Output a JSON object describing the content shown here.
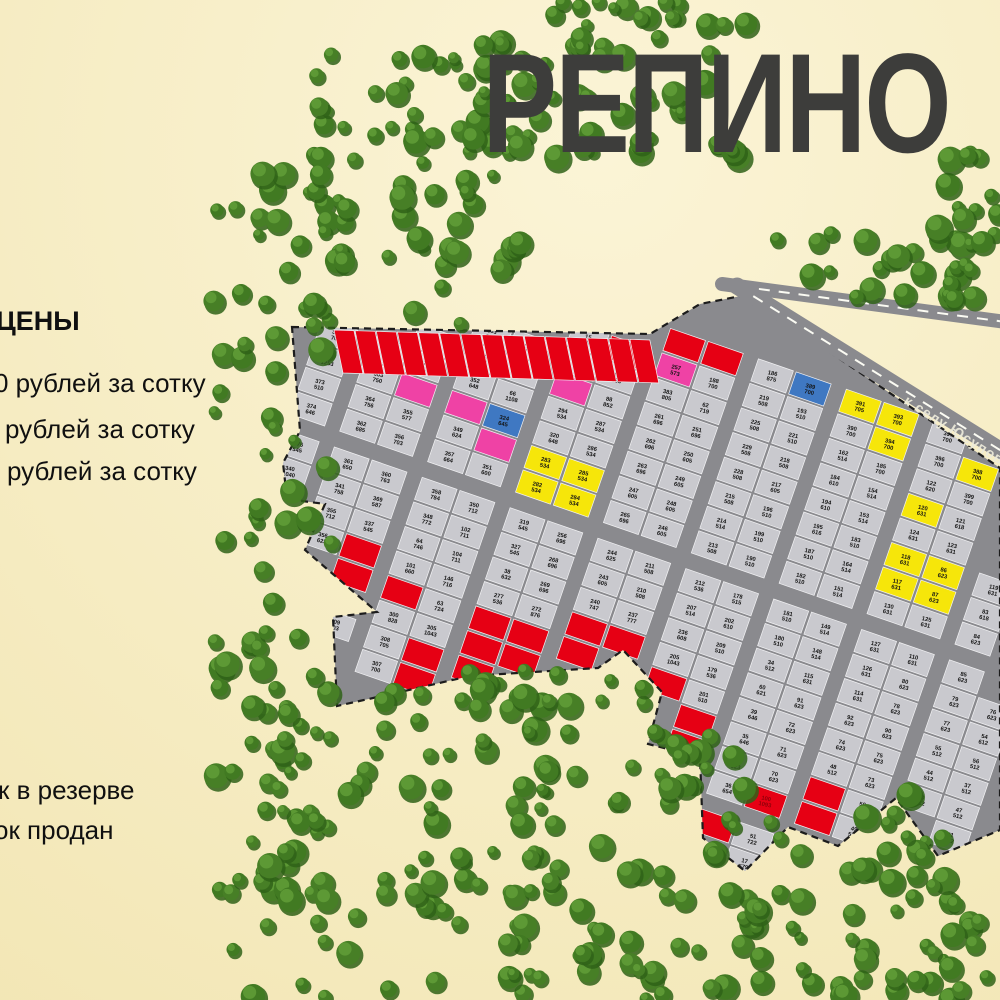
{
  "title": "РЕПИНО",
  "legend": {
    "heading": "ЦЕНЫ",
    "price_lines": [
      "0 рублей за сотку",
      "рублей за сотку",
      "рублей за сотку"
    ],
    "status_lines": [
      "к в резерве",
      "ок продан"
    ]
  },
  "road": {
    "label": "к селу Юсупово"
  },
  "palette": {
    "bg_light": "#faf3d2",
    "bg": "#f3e8ba",
    "forest_dark": "#2f6117",
    "forest": "#477f26",
    "forest_mid": "#417a22",
    "forest_light": "#63a03a",
    "road": "#8a8a8e",
    "plot": "#c9c9ce",
    "plot_line": "#f2f2f4",
    "boundary": "#1c1c1c",
    "red": "#e60014",
    "red_text": "#8f000a",
    "yellow": "#f6e60a",
    "pink": "#ef42a5",
    "blue": "#3f78c2",
    "title_color": "#3d3d3b",
    "text": "#141414",
    "road_dash": "#fbfbf3"
  },
  "map": {
    "estate_polygon": [
      [
        292,
        327
      ],
      [
        650,
        334
      ],
      [
        700,
        304
      ],
      [
        746,
        295
      ],
      [
        1000,
        468
      ],
      [
        1000,
        830
      ],
      [
        938,
        856
      ],
      [
        896,
        798
      ],
      [
        838,
        846
      ],
      [
        788,
        827
      ],
      [
        745,
        871
      ],
      [
        703,
        838
      ],
      [
        700,
        757
      ],
      [
        648,
        744
      ],
      [
        662,
        692
      ],
      [
        623,
        650
      ],
      [
        598,
        668
      ],
      [
        470,
        676
      ],
      [
        400,
        692
      ],
      [
        337,
        706
      ],
      [
        333,
        617
      ],
      [
        377,
        612
      ],
      [
        305,
        550
      ],
      [
        325,
        504
      ],
      [
        287,
        499
      ],
      [
        283,
        463
      ],
      [
        300,
        431
      ]
    ],
    "lattice": {
      "origin": [
        318,
        205
      ],
      "r": [
        0.945,
        0.327
      ],
      "c": [
        -0.327,
        0.945
      ],
      "depth": 40,
      "front": 26,
      "road_w": 13,
      "cross_w": 14,
      "rows": 19,
      "cols": 24,
      "pair": 2,
      "cross_every": 8
    },
    "red_row": {
      "x1": 334,
      "y1": 330,
      "x2": 651,
      "y2": 340,
      "count": 15,
      "lean": 9,
      "height": 43
    },
    "roads": [
      {
        "x1": 722,
        "y1": 284,
        "x2": 1006,
        "y2": 322,
        "w": 14
      },
      {
        "x1": 737,
        "y1": 286,
        "x2": 1008,
        "y2": 455,
        "w": 17
      }
    ],
    "areas_pool": [
      508,
      510,
      514,
      534,
      536,
      545,
      605,
      610,
      614,
      623,
      625,
      631,
      646,
      696,
      700,
      703,
      712,
      722
    ],
    "plots": [
      [
        724,
        308,
        "",
        "",
        "red"
      ],
      [
        676,
        332,
        "",
        "",
        "red"
      ],
      [
        652,
        348,
        "",
        "",
        "red"
      ],
      [
        333,
        568,
        "",
        "",
        "red"
      ],
      [
        351,
        581,
        "",
        "",
        "red"
      ],
      [
        368,
        594,
        "",
        "",
        "red"
      ],
      [
        405,
        650,
        "",
        "",
        "red"
      ],
      [
        425,
        658,
        "",
        "",
        "red"
      ],
      [
        447,
        664,
        "",
        "",
        "red"
      ],
      [
        467,
        670,
        "",
        "",
        "red"
      ],
      [
        482,
        652,
        "",
        "",
        "red"
      ],
      [
        502,
        656,
        "",
        "",
        "red"
      ],
      [
        522,
        660,
        "",
        "",
        "red"
      ],
      [
        541,
        664,
        "",
        "",
        "red"
      ],
      [
        560,
        667,
        "",
        "",
        "red"
      ],
      [
        611,
        658,
        "",
        "",
        "red"
      ],
      [
        650,
        698,
        "",
        "",
        "red"
      ],
      [
        667,
        718,
        "",
        "",
        "red"
      ],
      [
        683,
        740,
        "",
        "",
        "red"
      ],
      [
        721,
        812,
        "",
        "",
        "red"
      ],
      [
        760,
        813,
        "100",
        "1093",
        "red"
      ],
      [
        789,
        810,
        "",
        "",
        "red"
      ],
      [
        816,
        810,
        "",
        "",
        "red"
      ],
      [
        552,
        459,
        "283",
        "534",
        "yellow"
      ],
      [
        572,
        473,
        "285",
        "534",
        "yellow"
      ],
      [
        559,
        489,
        "284",
        "534",
        "yellow"
      ],
      [
        548,
        506,
        "282",
        "534",
        "yellow"
      ],
      [
        914,
        517,
        "120",
        "631",
        "yellow"
      ],
      [
        895,
        553,
        "118",
        "631",
        "yellow"
      ],
      [
        882,
        567,
        "117",
        "631",
        "yellow"
      ],
      [
        932,
        567,
        "86",
        "623",
        "yellow"
      ],
      [
        922,
        581,
        "87",
        "623",
        "yellow"
      ],
      [
        853,
        393,
        "391",
        "705",
        "yellow"
      ],
      [
        886,
        419,
        "393",
        "700",
        "yellow"
      ],
      [
        905,
        432,
        "394",
        "700",
        "yellow"
      ],
      [
        965,
        471,
        "388",
        "700",
        "yellow"
      ],
      [
        504,
        424,
        "324",
        "645",
        "blue"
      ],
      [
        799,
        367,
        "389",
        "700",
        "blue"
      ],
      [
        432,
        403,
        "",
        "",
        "pink"
      ],
      [
        457,
        401,
        "",
        "",
        "pink"
      ],
      [
        491,
        442,
        "",
        "",
        "pink"
      ],
      [
        551,
        369,
        "",
        "",
        "pink"
      ],
      [
        696,
        372,
        "257",
        "573",
        "pink"
      ],
      [
        322,
        350,
        "365",
        "1253"
      ],
      [
        345,
        396,
        "364",
        "756"
      ],
      [
        369,
        398,
        "363",
        "750"
      ],
      [
        352,
        421,
        "362",
        "685"
      ],
      [
        358,
        448,
        "361",
        "650"
      ],
      [
        364,
        468,
        "360",
        "763"
      ],
      [
        296,
        477,
        "340",
        "1040"
      ],
      [
        330,
        492,
        "341",
        "758"
      ],
      [
        362,
        492,
        "369",
        "587"
      ],
      [
        406,
        404,
        "355",
        "577"
      ],
      [
        400,
        432,
        "356",
        "703"
      ],
      [
        398,
        458,
        "357",
        "664"
      ],
      [
        400,
        488,
        "358",
        "784"
      ],
      [
        433,
        459,
        "349",
        "624"
      ],
      [
        432,
        488,
        "348",
        "772"
      ],
      [
        353,
        602,
        "309",
        "703"
      ],
      [
        347,
        625,
        "308",
        "705"
      ],
      [
        340,
        644,
        "307",
        "700"
      ],
      [
        335,
        663,
        "300",
        "828"
      ],
      [
        379,
        659,
        "305",
        "1043"
      ],
      [
        478,
        408,
        "352",
        "648"
      ],
      [
        478,
        428,
        "351",
        "600"
      ],
      [
        470,
        450,
        "350",
        "712"
      ],
      [
        524,
        442,
        "320",
        "648"
      ],
      [
        516,
        472,
        "319",
        "545"
      ],
      [
        510,
        492,
        "327",
        "545"
      ],
      [
        596,
        436,
        "287",
        "534"
      ],
      [
        585,
        452,
        "286",
        "534"
      ],
      [
        539,
        475,
        "294",
        "534"
      ],
      [
        602,
        498,
        "265",
        "696"
      ],
      [
        622,
        466,
        "263",
        "696"
      ],
      [
        637,
        449,
        "262",
        "696"
      ],
      [
        590,
        515,
        "256",
        "696"
      ],
      [
        570,
        546,
        "268",
        "696"
      ],
      [
        558,
        561,
        "269",
        "696"
      ],
      [
        607,
        550,
        "244",
        "625"
      ],
      [
        600,
        566,
        "243",
        "605"
      ],
      [
        482,
        607,
        "277",
        "536"
      ],
      [
        521,
        614,
        "272",
        "876"
      ],
      [
        555,
        612,
        "240",
        "747"
      ],
      [
        596,
        659,
        "237",
        "777"
      ],
      [
        637,
        673,
        "205",
        "1043"
      ],
      [
        648,
        433,
        "261",
        "696"
      ],
      [
        682,
        431,
        "251",
        "696"
      ],
      [
        671,
        437,
        "250",
        "605"
      ],
      [
        671,
        467,
        "249",
        "605"
      ],
      [
        663,
        482,
        "248",
        "605"
      ],
      [
        653,
        498,
        "247",
        "605"
      ],
      [
        648,
        514,
        "246",
        "605"
      ],
      [
        731,
        429,
        "225",
        "508"
      ],
      [
        718,
        445,
        "229",
        "508"
      ],
      [
        708,
        465,
        "228",
        "508"
      ],
      [
        720,
        493,
        "215",
        "508"
      ],
      [
        707,
        510,
        "214",
        "514"
      ],
      [
        698,
        528,
        "213",
        "508"
      ],
      [
        688,
        545,
        "212",
        "536"
      ],
      [
        678,
        562,
        "211",
        "508"
      ],
      [
        668,
        580,
        "210",
        "508"
      ],
      [
        603,
        610,
        "236",
        "608"
      ],
      [
        635,
        622,
        "207",
        "514"
      ],
      [
        660,
        624,
        "209",
        "510"
      ],
      [
        678,
        613,
        "202",
        "610"
      ],
      [
        712,
        622,
        "178",
        "515"
      ],
      [
        680,
        655,
        "179",
        "536"
      ],
      [
        702,
        574,
        "190",
        "510"
      ],
      [
        693,
        589,
        "199",
        "510"
      ],
      [
        690,
        604,
        "201",
        "510"
      ],
      [
        800,
        427,
        "221",
        "510"
      ],
      [
        758,
        426,
        "219",
        "508"
      ],
      [
        751,
        443,
        "218",
        "508"
      ],
      [
        743,
        460,
        "217",
        "605"
      ],
      [
        748,
        518,
        "196",
        "510"
      ],
      [
        735,
        530,
        "187",
        "510"
      ],
      [
        726,
        543,
        "182",
        "510"
      ],
      [
        721,
        557,
        "181",
        "510"
      ],
      [
        717,
        576,
        "180",
        "510"
      ],
      [
        774,
        463,
        "193",
        "510"
      ],
      [
        763,
        477,
        "194",
        "610"
      ],
      [
        756,
        493,
        "195",
        "616"
      ],
      [
        773,
        508,
        "184",
        "610"
      ],
      [
        765,
        524,
        "183",
        "510"
      ],
      [
        840,
        475,
        "162",
        "514"
      ],
      [
        801,
        544,
        "164",
        "514"
      ],
      [
        814,
        560,
        "151",
        "514"
      ],
      [
        789,
        591,
        "149",
        "514"
      ],
      [
        784,
        607,
        "148",
        "514"
      ],
      [
        827,
        606,
        "130",
        "631"
      ],
      [
        842,
        508,
        "153",
        "514"
      ],
      [
        834,
        528,
        "154",
        "514"
      ],
      [
        750,
        330,
        "186",
        "875"
      ],
      [
        770,
        340,
        "188",
        "700"
      ],
      [
        700,
        313,
        "383",
        "805"
      ],
      [
        812,
        368,
        "390",
        "700"
      ],
      [
        835,
        380,
        "185",
        "700"
      ],
      [
        935,
        447,
        "396",
        "700"
      ],
      [
        950,
        458,
        "397",
        "700"
      ],
      [
        982,
        479,
        "399",
        "700"
      ],
      [
        919,
        487,
        "122",
        "620"
      ],
      [
        930,
        498,
        "121",
        "618"
      ],
      [
        889,
        498,
        "124",
        "631"
      ],
      [
        877,
        514,
        "123",
        "631"
      ],
      [
        871,
        534,
        "125",
        "631"
      ],
      [
        860,
        552,
        "127",
        "631"
      ],
      [
        845,
        568,
        "126",
        "631"
      ],
      [
        872,
        587,
        "110",
        "631"
      ],
      [
        853,
        605,
        "115",
        "631"
      ],
      [
        850,
        619,
        "114",
        "631"
      ],
      [
        902,
        537,
        "119",
        "631"
      ],
      [
        965,
        512,
        "83",
        "618"
      ],
      [
        950,
        532,
        "84",
        "623"
      ],
      [
        948,
        546,
        "85",
        "623"
      ],
      [
        968,
        564,
        "80",
        "623"
      ],
      [
        958,
        581,
        "79",
        "623"
      ],
      [
        948,
        597,
        "78",
        "623"
      ],
      [
        934,
        614,
        "77",
        "623"
      ],
      [
        898,
        616,
        "92",
        "623"
      ],
      [
        885,
        634,
        "90",
        "623"
      ],
      [
        925,
        632,
        "76",
        "623"
      ],
      [
        975,
        617,
        "54",
        "612"
      ],
      [
        963,
        634,
        "55",
        "512"
      ],
      [
        872,
        650,
        "91",
        "623"
      ],
      [
        908,
        650,
        "75",
        "623"
      ],
      [
        953,
        650,
        "56",
        "512"
      ],
      [
        985,
        652,
        "44",
        "512"
      ],
      [
        896,
        668,
        "74",
        "623"
      ],
      [
        946,
        666,
        "37",
        "512"
      ],
      [
        979,
        666,
        "43",
        "512"
      ],
      [
        884,
        686,
        "73",
        "623"
      ],
      [
        932,
        684,
        "48",
        "512"
      ],
      [
        962,
        682,
        "47",
        "512"
      ],
      [
        870,
        702,
        "72",
        "623"
      ],
      [
        920,
        700,
        "50",
        "512"
      ],
      [
        950,
        698,
        "41",
        "512"
      ],
      [
        857,
        719,
        "71",
        "623"
      ],
      [
        908,
        716,
        "49",
        "512"
      ],
      [
        986,
        707,
        "34",
        "512"
      ],
      [
        845,
        736,
        "70",
        "623"
      ],
      [
        900,
        733,
        "60",
        "621"
      ],
      [
        912,
        753,
        "39",
        "646"
      ],
      [
        976,
        731,
        "35",
        "646"
      ],
      [
        840,
        755,
        "69",
        "623"
      ],
      [
        880,
        768,
        "51",
        "722"
      ],
      [
        965,
        747,
        "36",
        "654"
      ],
      [
        985,
        756,
        "17",
        "579"
      ],
      [
        887,
        769,
        "62",
        "719"
      ],
      [
        919,
        771,
        "38",
        "632"
      ],
      [
        863,
        787,
        "63",
        "724"
      ],
      [
        691,
        754,
        "146",
        "716"
      ],
      [
        713,
        792,
        "104",
        "711"
      ],
      [
        721,
        834,
        "102",
        "711"
      ],
      [
        742,
        854,
        "101",
        "660"
      ],
      [
        800,
        771,
        "88",
        "852"
      ],
      [
        835,
        770,
        "68",
        "833"
      ],
      [
        862,
        806,
        "64",
        "746"
      ],
      [
        851,
        820,
        "65",
        "767"
      ],
      [
        842,
        837,
        "66",
        "1108"
      ],
      [
        952,
        800,
        "15",
        "933"
      ]
    ]
  },
  "forest_regions": [
    [
      212,
      118,
      120,
      782,
      88
    ],
    [
      318,
      128,
      205,
      200,
      46
    ],
    [
      298,
      52,
      245,
      88,
      24
    ],
    [
      545,
      0,
      215,
      60,
      24
    ],
    [
      468,
      42,
      185,
      118,
      26
    ],
    [
      638,
      82,
      115,
      88,
      13
    ],
    [
      772,
      226,
      230,
      74,
      28
    ],
    [
      938,
      148,
      64,
      104,
      12
    ],
    [
      224,
      678,
      315,
      322,
      78
    ],
    [
      520,
      698,
      235,
      292,
      54
    ],
    [
      738,
      818,
      235,
      182,
      38
    ],
    [
      466,
      670,
      185,
      42,
      15
    ],
    [
      643,
      742,
      72,
      62,
      9
    ],
    [
      856,
      790,
      58,
      74,
      8
    ],
    [
      916,
      902,
      86,
      98,
      10
    ],
    [
      618,
      958,
      330,
      42,
      12
    ]
  ]
}
